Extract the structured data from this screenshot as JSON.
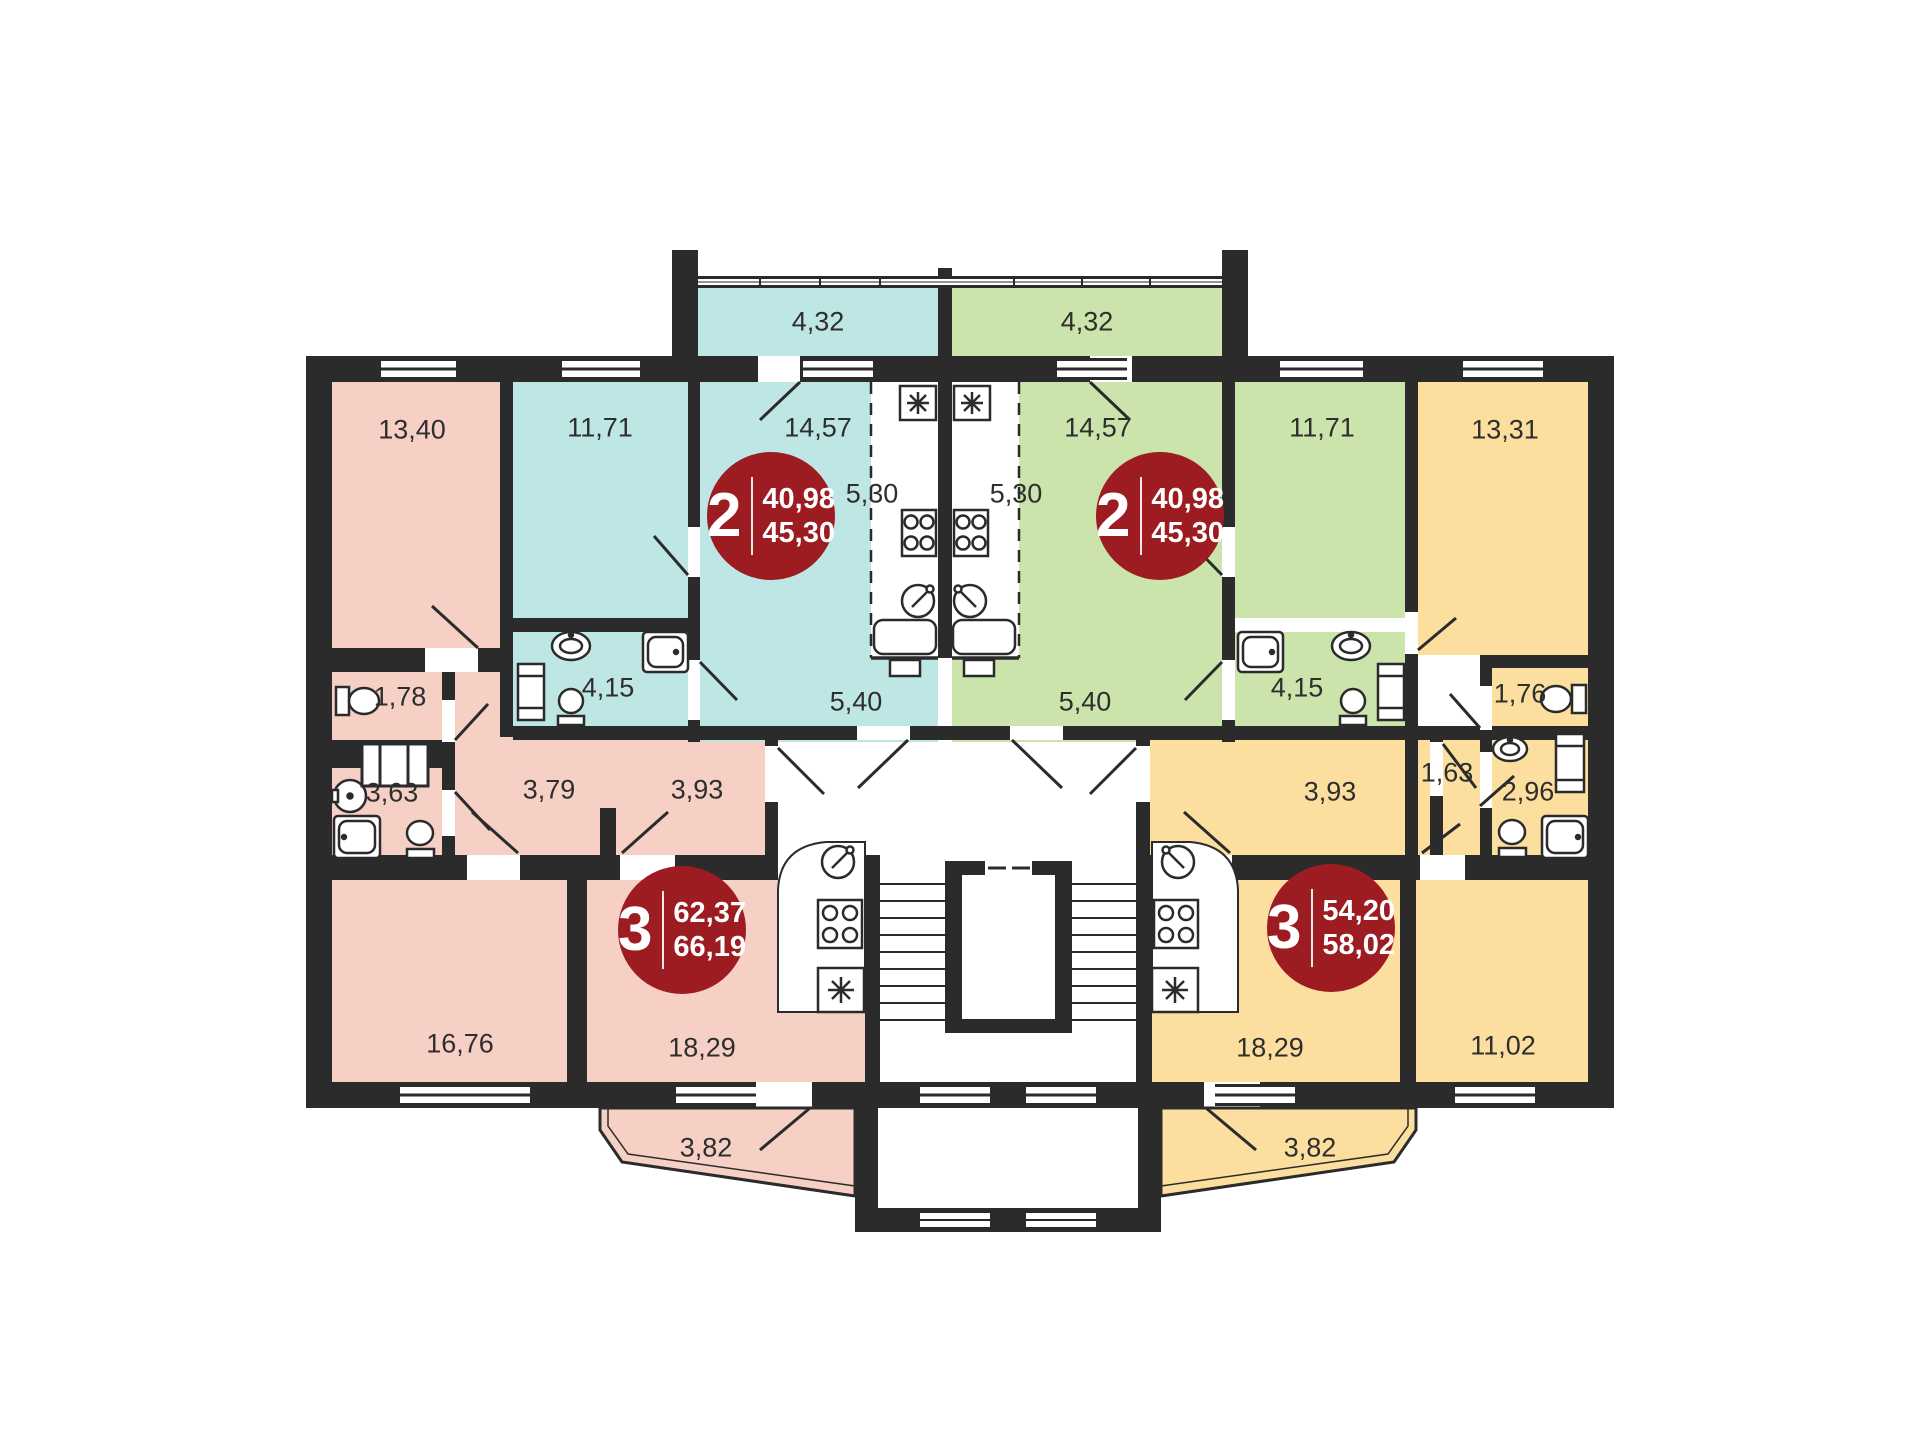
{
  "title": "Типовой этаж — план секции",
  "colors": {
    "wall": "#2b2b2b",
    "badge": "#9d1c21",
    "apartment_pink": "#f6cfc5",
    "apartment_cyan": "#bee6e4",
    "apartment_green": "#cbe4ab",
    "apartment_yellow": "#fcdf9f"
  },
  "apartments": [
    {
      "key": "two-room-left",
      "color_name": "cyan",
      "badge": {
        "rooms": "2",
        "area_living": "40,98",
        "area_total": "45,30"
      },
      "rooms": {
        "balcony": "4,32",
        "bedroom": "11,71",
        "living": "14,57",
        "kitchen": "5,30",
        "bath": "4,15",
        "hall": "5,40"
      }
    },
    {
      "key": "two-room-right",
      "color_name": "green",
      "badge": {
        "rooms": "2",
        "area_living": "40,98",
        "area_total": "45,30"
      },
      "rooms": {
        "balcony": "4,32",
        "bedroom": "11,71",
        "living": "14,57",
        "kitchen": "5,30",
        "bath": "4,15",
        "hall": "5,40"
      }
    },
    {
      "key": "three-room-left",
      "color_name": "pink",
      "badge": {
        "rooms": "3",
        "area_living": "62,37",
        "area_total": "66,19"
      },
      "rooms": {
        "bedroom1": "13,40",
        "wc": "1,78",
        "bath": "3,63",
        "hall1": "3,79",
        "hall2": "3,93",
        "bedroom2": "16,76",
        "living": "18,29",
        "balcony": "3,82"
      }
    },
    {
      "key": "three-room-right",
      "color_name": "yellow",
      "badge": {
        "rooms": "3",
        "area_living": "54,20",
        "area_total": "58,02"
      },
      "rooms": {
        "bedroom1": "13,31",
        "wc": "1,76",
        "bath": "2,96",
        "closet": "1,63",
        "hall": "3,93",
        "living": "18,29",
        "bedroom2": "11,02",
        "balcony": "3,82"
      }
    }
  ]
}
